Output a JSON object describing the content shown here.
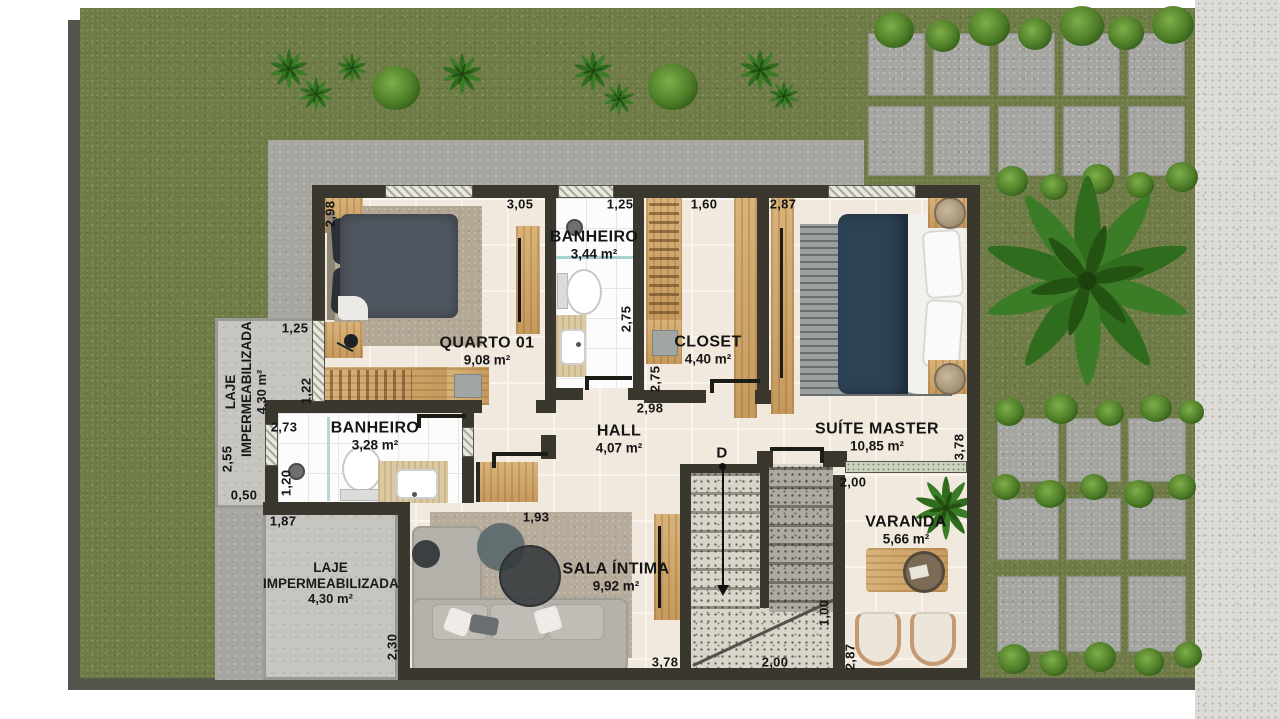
{
  "rooms": [
    {
      "name": "QUARTO 01",
      "area": "9,08 m²"
    },
    {
      "name": "BANHEIRO",
      "area": "3,44 m²"
    },
    {
      "name": "CLOSET",
      "area": "4,40 m²"
    },
    {
      "name": "SUÍTE MASTER",
      "area": "10,85 m²"
    },
    {
      "name": "HALL",
      "area": "4,07 m²"
    },
    {
      "name": "BANHEIRO",
      "area": "3,28 m²"
    },
    {
      "name": "SALA ÍNTIMA",
      "area": "9,92 m²"
    },
    {
      "name": "VARANDA",
      "area": "5,66 m²"
    },
    {
      "name": "LAJE IMPERMEABILIZADA",
      "area": "4,30 m²"
    },
    {
      "name": "LAJE IMPERMEABILIZADA",
      "area": "4,30 m²"
    }
  ],
  "dimensions": [
    {
      "v": "2,98"
    },
    {
      "v": "3,05"
    },
    {
      "v": "1,25"
    },
    {
      "v": "1,60"
    },
    {
      "v": "2,87"
    },
    {
      "v": "1,25"
    },
    {
      "v": "1,22"
    },
    {
      "v": "2,55"
    },
    {
      "v": "0,50"
    },
    {
      "v": "2,73"
    },
    {
      "v": "1,20"
    },
    {
      "v": "1,87"
    },
    {
      "v": "2,30"
    },
    {
      "v": "2,75"
    },
    {
      "v": "2,75"
    },
    {
      "v": "2,98"
    },
    {
      "v": "3,78"
    },
    {
      "v": "2,00"
    },
    {
      "v": "1,00"
    },
    {
      "v": "2,87"
    },
    {
      "v": "3,78"
    },
    {
      "v": "2,00"
    },
    {
      "v": "1,93"
    }
  ],
  "stairs": {
    "direction_label": "D"
  },
  "palette": {
    "wall": "#3a382e",
    "floor_tile": "#f1e9dd",
    "grass": "#6e7b46",
    "laje_concrete": "#c5c4bf",
    "wood": "#cfa567",
    "suite_bed_blue": "#2d4254",
    "paver_gray": "#a5a6a2"
  }
}
